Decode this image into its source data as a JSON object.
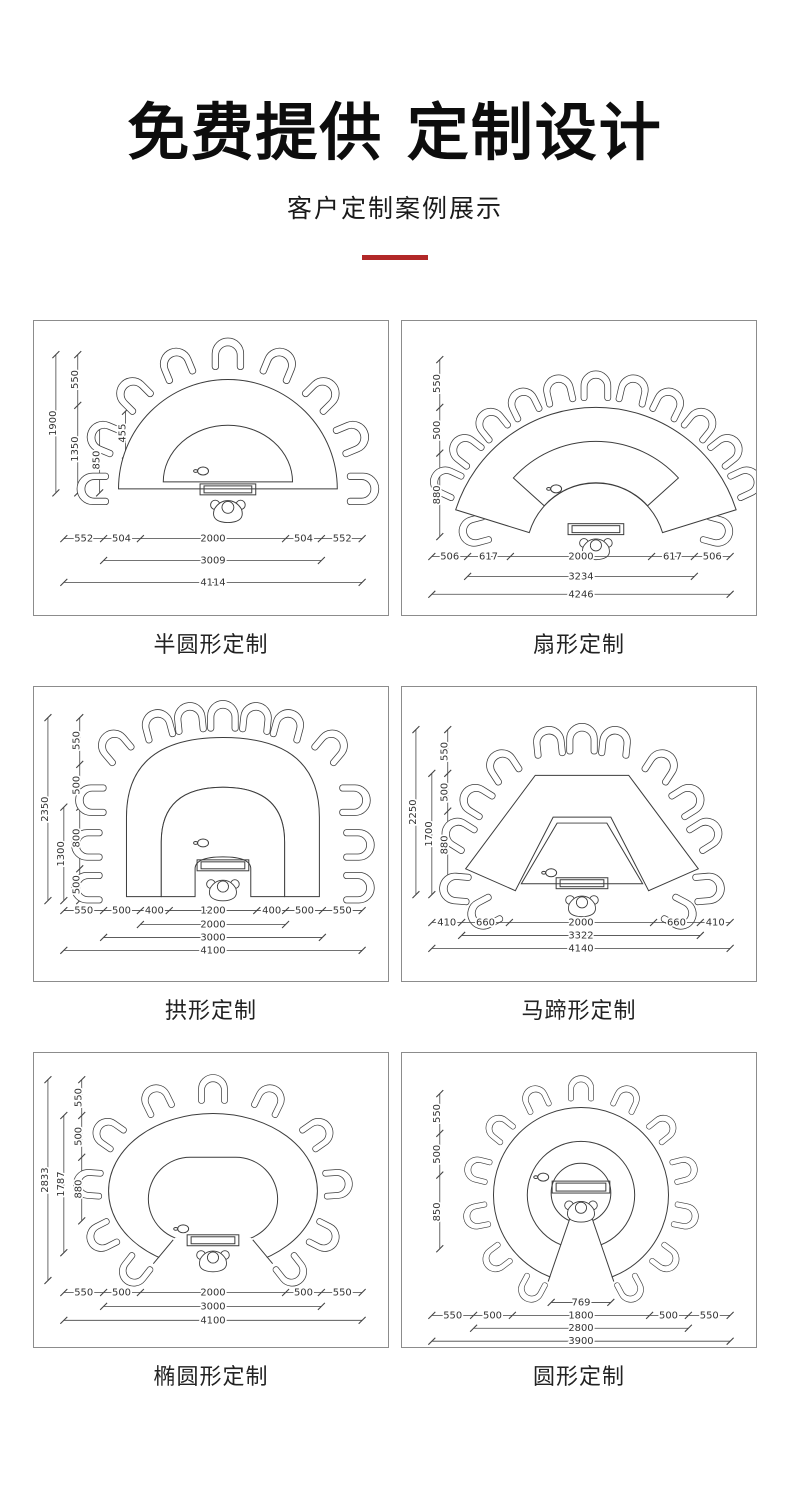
{
  "header": {
    "title": "免费提供 定制设计",
    "subtitle": "客户定制案例展示"
  },
  "colors": {
    "accent": "#b22828",
    "cad_line": "#3c3c3c",
    "panel_border": "#8c8c8c"
  },
  "panels": [
    {
      "caption": "半圆形定制",
      "v": [
        "1900",
        "550",
        "1350",
        "455",
        "850"
      ],
      "h": [
        "552",
        "504",
        "2000",
        "504",
        "552",
        "3009",
        "4114"
      ]
    },
    {
      "caption": "扇形定制",
      "v": [
        "550",
        "500",
        "880"
      ],
      "h": [
        "506",
        "617",
        "2000",
        "617",
        "506",
        "3234",
        "4246"
      ]
    },
    {
      "caption": "拱形定制",
      "v": [
        "2350",
        "1300",
        "550",
        "500",
        "800",
        "500"
      ],
      "h": [
        "550",
        "500",
        "400",
        "1200",
        "400",
        "500",
        "550",
        "2000",
        "3000",
        "4100"
      ]
    },
    {
      "caption": "马蹄形定制",
      "v": [
        "2250",
        "1700",
        "550",
        "500",
        "880"
      ],
      "h": [
        "410",
        "660",
        "2000",
        "660",
        "410",
        "3322",
        "4140"
      ]
    },
    {
      "caption": "椭圆形定制",
      "v": [
        "2833",
        "1787",
        "550",
        "500",
        "880"
      ],
      "h": [
        "550",
        "500",
        "2000",
        "500",
        "550",
        "3000",
        "4100"
      ]
    },
    {
      "caption": "圆形定制",
      "v": [
        "550",
        "500",
        "850"
      ],
      "h": [
        "769",
        "550",
        "500",
        "1800",
        "500",
        "550",
        "2800",
        "3900"
      ]
    }
  ]
}
